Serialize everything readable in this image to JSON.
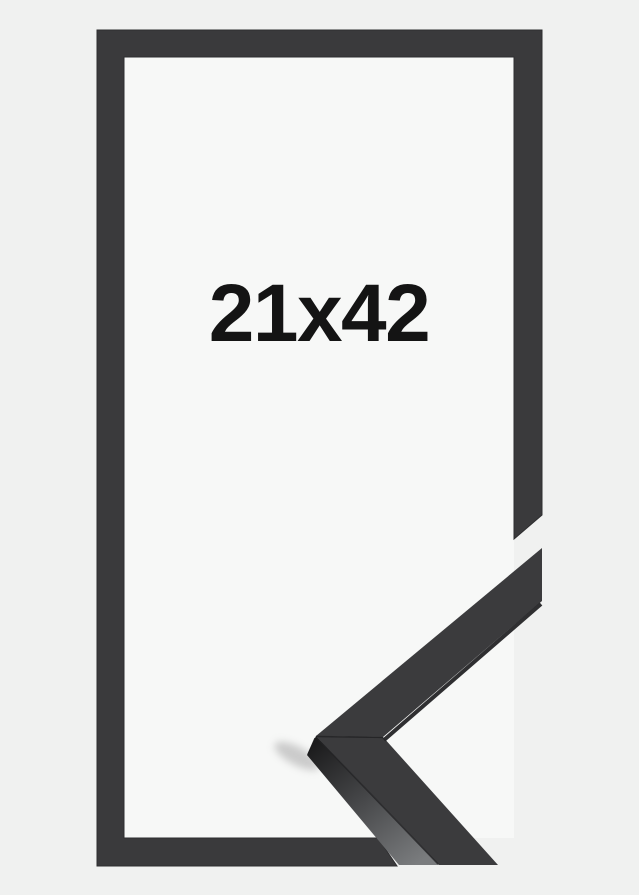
{
  "product_image": {
    "size_label": "21x42",
    "description": "Black picture frame product image: flat frame outline with size label and 3D mitered corner profile detail"
  },
  "colors": {
    "background": "#f0f1f0",
    "opening": "#f7f8f7",
    "frame": "#3a3a3c",
    "profile_face": "#3b3b3d",
    "label_text": "#141414",
    "shadow": "#c0c0c0"
  }
}
